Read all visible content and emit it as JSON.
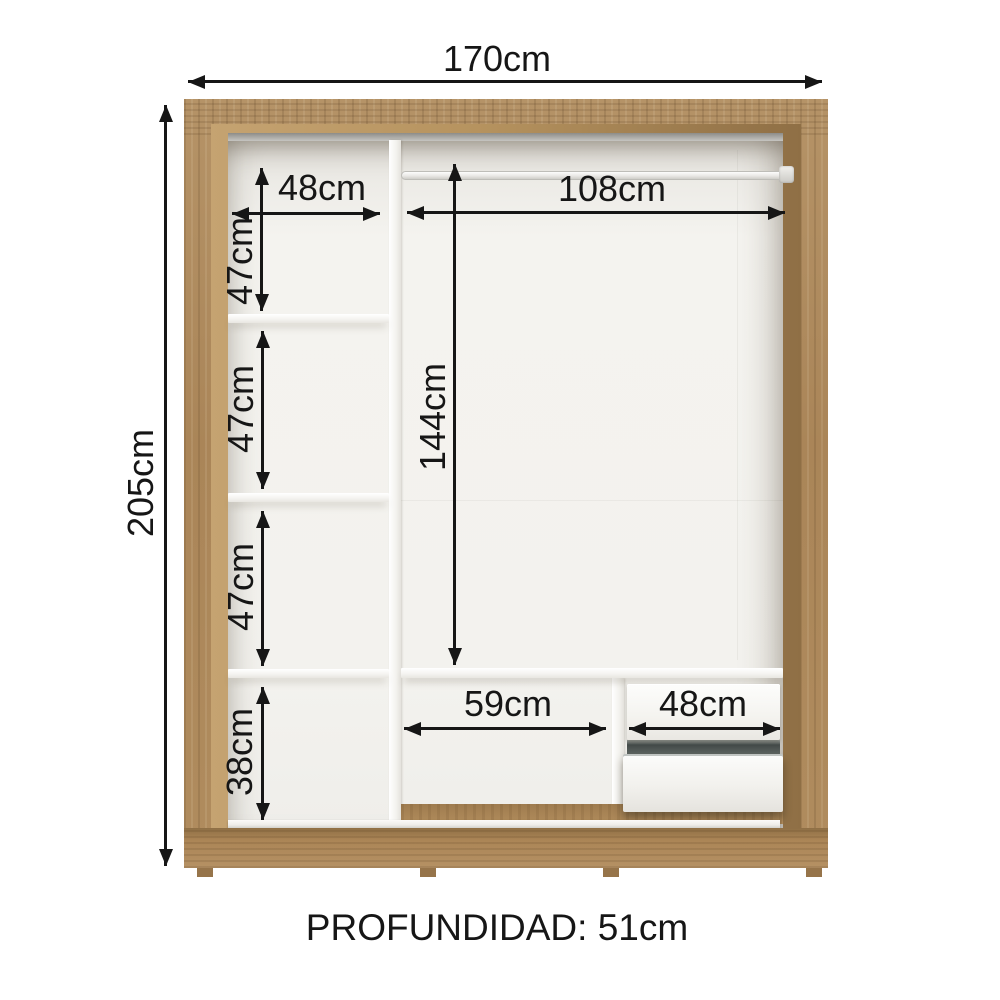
{
  "diagram_type": "wardrobe-internal-dimensions",
  "labels": {
    "total_width": "170cm",
    "total_height": "205cm",
    "left_shelf_width": "48cm",
    "left_section_1_height": "47cm",
    "left_section_2_height": "47cm",
    "left_section_3_height": "47cm",
    "left_section_4_height": "38cm",
    "rod_span_width": "108cm",
    "hanging_area_height": "144cm",
    "bottom_middle_width": "59cm",
    "drawer_section_width": "48cm"
  },
  "footer": {
    "depth_label": "PROFUNDIDAD: 51cm"
  },
  "colors": {
    "wood": "#b08c5e",
    "wood_shadow": "#8f6f45",
    "wood_light": "#c5a371",
    "interior_back": "#f3f2ee",
    "panel_white": "#fafaf8",
    "slot_dark": "#434a48",
    "dimension_ink": "#161616",
    "background": "#ffffff"
  }
}
